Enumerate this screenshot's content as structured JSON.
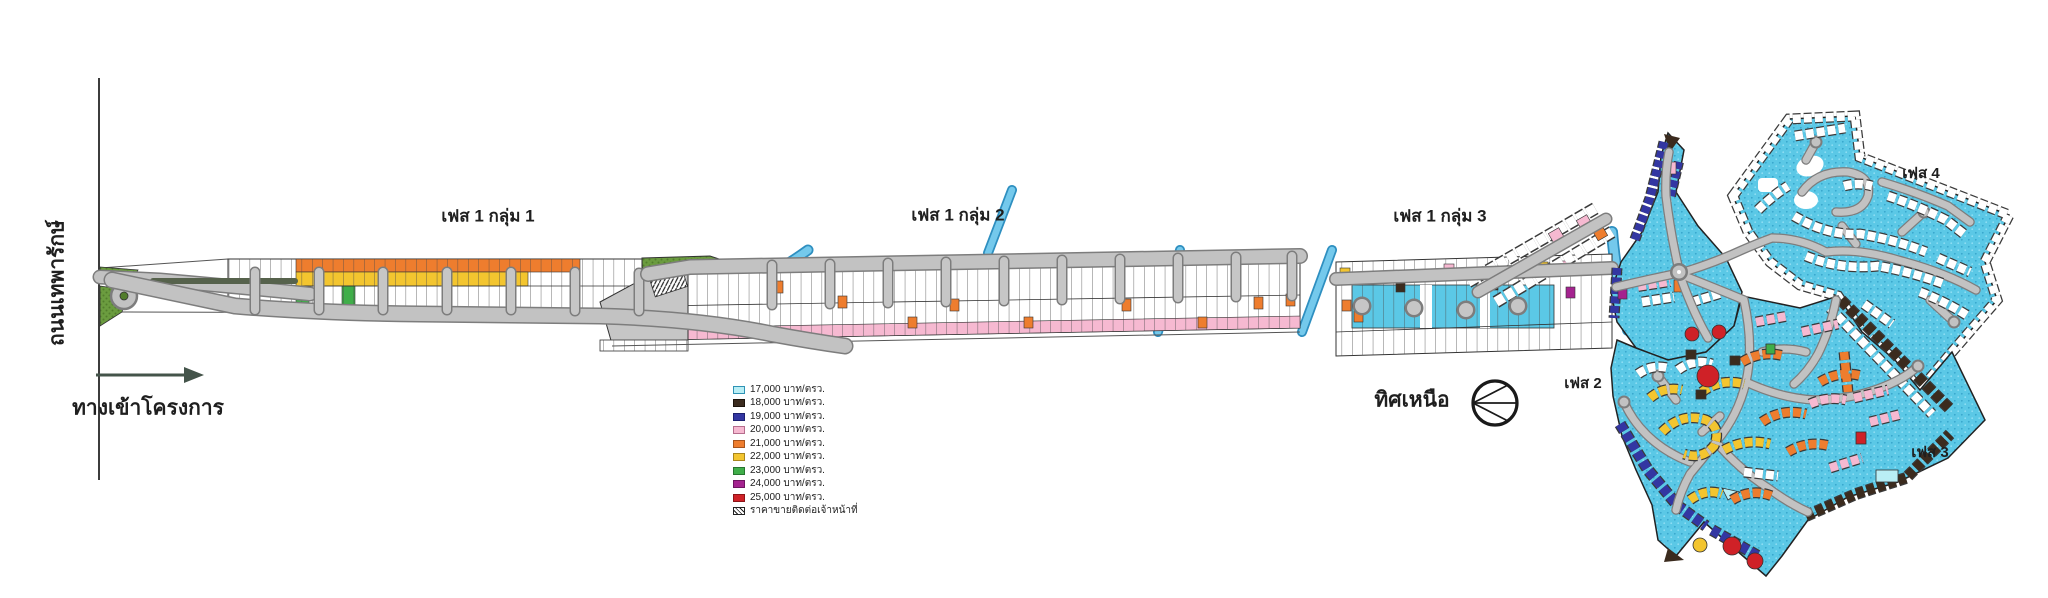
{
  "labels": {
    "road": "ถนนเทพารักษ์",
    "entrance": "ทางเข้าโครงการ",
    "north": "ทิศเหนือ",
    "phase1_group1": "เฟส 1 กลุ่ม 1",
    "phase1_group2": "เฟส 1 กลุ่ม 2",
    "phase1_group3": "เฟส 1 กลุ่ม 3",
    "phase2": "เฟส 2",
    "phase3": "เฟส 3",
    "phase4": "เฟส 4"
  },
  "legend": {
    "items": [
      {
        "label": "17,000 บาท/ตรว.",
        "color": "#b9eef5",
        "border": "#2f93b5"
      },
      {
        "label": "18,000 บาท/ตรว.",
        "color": "#3b2b1e",
        "border": "#1c130b"
      },
      {
        "label": "19,000 บาท/ตรว.",
        "color": "#3336a2",
        "border": "#1d2070"
      },
      {
        "label": "20,000 บาท/ตรว.",
        "color": "#f6b9d1",
        "border": "#b56d8d"
      },
      {
        "label": "21,000 บาท/ตรว.",
        "color": "#ee7d2e",
        "border": "#a6541d"
      },
      {
        "label": "22,000 บาท/ตรว.",
        "color": "#f3c52f",
        "border": "#a8861e"
      },
      {
        "label": "23,000 บาท/ตรว.",
        "color": "#3fae49",
        "border": "#27742f"
      },
      {
        "label": "24,000 บาท/ตรว.",
        "color": "#a4238f",
        "border": "#6e1560"
      },
      {
        "label": "25,000 บาท/ตรว.",
        "color": "#cf2127",
        "border": "#8c1418"
      },
      {
        "label": "ราคาขายติดต่อเจ้าหน้าที่",
        "hatch": true
      }
    ]
  },
  "map_colors": {
    "development_water": "#5bc8e6",
    "road_fill": "#c2c2c2",
    "road_edge": "#7d7d7d",
    "grass": "#6b9c3f",
    "canal": "#74c9ec",
    "plot_white": "#ffffff",
    "border_navy": "#3336a2",
    "border_brown": "#3b2b1e"
  }
}
